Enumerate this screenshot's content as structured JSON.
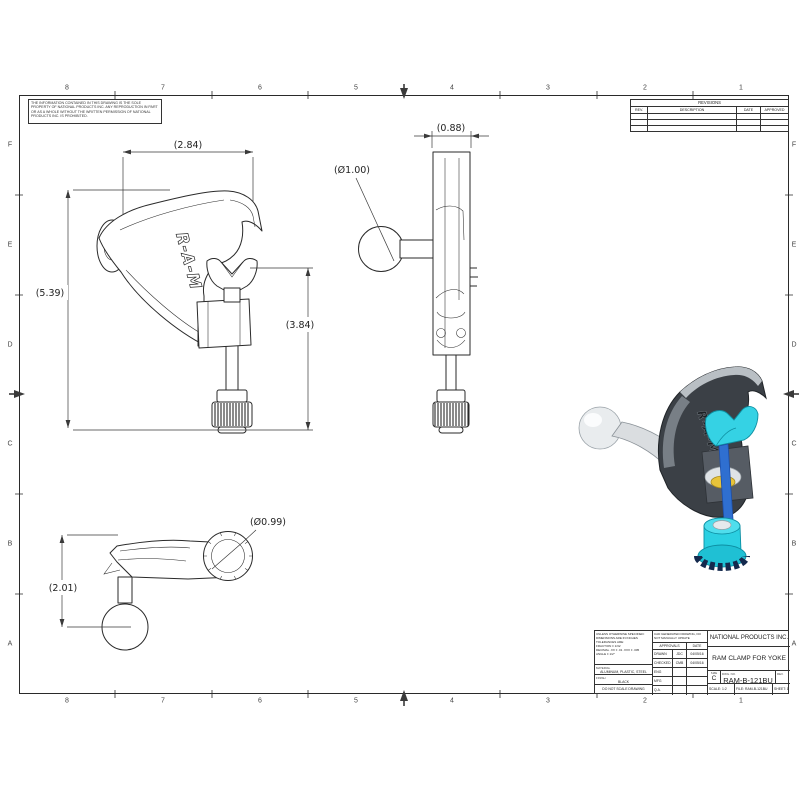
{
  "sheet": {
    "zone_numbers": [
      "8",
      "7",
      "6",
      "5",
      "4",
      "3",
      "2",
      "1"
    ],
    "zone_letters": [
      "F",
      "E",
      "D",
      "C",
      "B",
      "A"
    ],
    "proprietary_note": "THE INFORMATION CONTAINED IN THIS DRAWING IS THE SOLE PROPERTY OF NATIONAL PRODUCTS INC. ANY REPRODUCTION IN PART OR AS A WHOLE WITHOUT THE WRITTEN PERMISSION OF NATIONAL PRODUCTS INC. IS PROHIBITED."
  },
  "revisions": {
    "title": "REVISIONS",
    "columns": [
      "REV.",
      "DESCRIPTION",
      "DATE",
      "APPROVED"
    ]
  },
  "part_label": "R-A-M",
  "dimensions": {
    "front_width": "(2.84)",
    "overall_height": "(5.39)",
    "jaw_to_knob": "(3.84)",
    "side_width": "(0.88)",
    "ball_diameter": "(Ø1.00)",
    "arm_drop": "(2.01)",
    "screw_boss_diameter": "(Ø0.99)"
  },
  "title_block": {
    "company": "NATIONAL PRODUCTS INC.",
    "drawing_title": "RAM CLAMP FOR YOKE",
    "drawing_number": "RAM-B-121BU",
    "size_label": "SIZE",
    "size": "C",
    "dwg_no_label": "DWG. NO.",
    "rev_label": "REV.",
    "scale": "SCALE: 1:2",
    "file": "FILE: RAM-B-121BU",
    "sheet": "SHEET: 1 OF 1",
    "tolerance_note": "UNLESS OTHERWISE SPECIFIED:\nDIMENSIONS ARE IN INCHES\nTOLERANCES ARE:\nFRACTION ± 1/32\nDECIMAL .XX ± .01  .XXX ± .005\nANGLE ± 1/2°",
    "cad_note": "CAD GENERATED DRAWING, DO NOT MANUALLY UPDATE",
    "material_label": "MATERIAL",
    "material": "ALUMINUM, PLASTIC, STEEL",
    "finish_label": "FINISH",
    "finish": "BLACK",
    "do_not_scale": "DO NOT SCALE DRAWING",
    "approvals": {
      "header": "APPROVALS",
      "date_header": "DATE",
      "rows": [
        {
          "label": "DRAWN",
          "name": "JDC",
          "date": "04/05/16"
        },
        {
          "label": "CHECKED",
          "name": "CMB",
          "date": "04/05/16"
        },
        {
          "label": "ENG APPR.",
          "name": "",
          "date": ""
        },
        {
          "label": "MFG APPR.",
          "name": "",
          "date": ""
        },
        {
          "label": "Q.A.",
          "name": "",
          "date": ""
        }
      ]
    }
  },
  "colors": {
    "body": "#3b4046",
    "ball": "#edeff1",
    "jaw": "#35d2e4",
    "rod": "#2f6fd0",
    "washer": "#e7c33a",
    "knob": "#2bd0e2",
    "line": "#2a2a2a"
  }
}
